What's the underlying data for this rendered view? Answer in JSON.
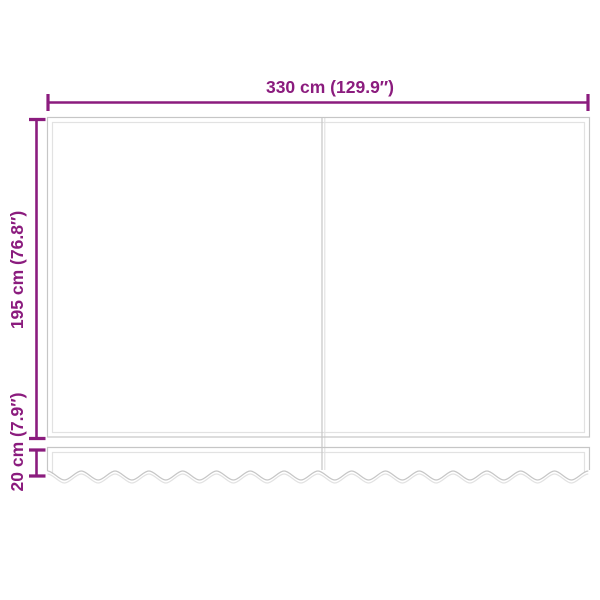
{
  "diagram": {
    "type": "product-dimension-diagram",
    "subject": "replacement awning fabric with wavy valance, two panels",
    "labels": {
      "width": "330 cm (129.9″)",
      "height": "195 cm (76.8″)",
      "valance_height": "20 cm (7.9″)"
    },
    "measurements": {
      "width_cm": 330,
      "width_in": 129.9,
      "height_cm": 195,
      "height_in": 76.8,
      "valance_cm": 20,
      "valance_in": 7.9
    },
    "colors": {
      "dimension": "#8b1c7e",
      "outline": "#c6c6c6",
      "outline_inner": "#e2e2e2",
      "background": "#ffffff"
    }
  }
}
